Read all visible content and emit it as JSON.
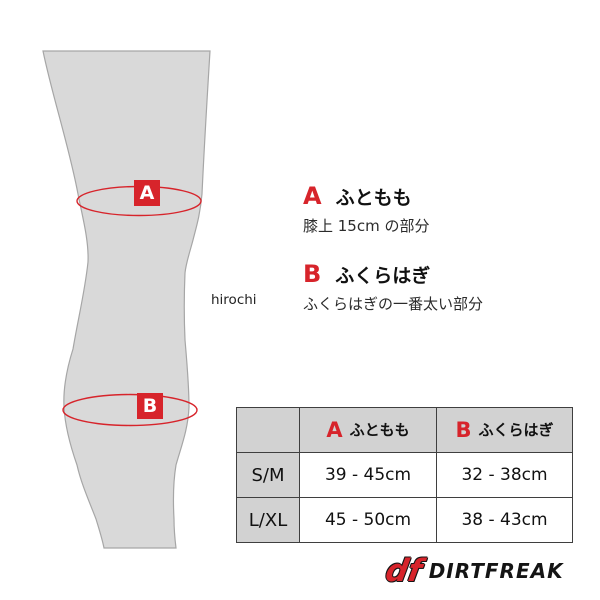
{
  "diagram": {
    "watermark": "hirochi",
    "markers": [
      {
        "letter": "A"
      },
      {
        "letter": "B"
      }
    ]
  },
  "legend": {
    "items": [
      {
        "letter": "A",
        "title": "ふともも",
        "desc": "膝上 15cm の部分"
      },
      {
        "letter": "B",
        "title": "ふくらはぎ",
        "desc": "ふくらはぎの一番太い部分"
      }
    ]
  },
  "size_table": {
    "header": {
      "columns": [
        {
          "letter": "A",
          "label": "ふともも"
        },
        {
          "letter": "B",
          "label": "ふくらはぎ"
        }
      ]
    },
    "rows": [
      {
        "size": "S/M",
        "thigh": "39 - 45cm",
        "calf": "32 - 38cm"
      },
      {
        "size": "L/XL",
        "thigh": "45 - 50cm",
        "calf": "38 - 43cm"
      }
    ]
  },
  "brand": {
    "emblem": "df",
    "name": "DIRTFREAK"
  },
  "colors": {
    "accent_red": "#d7242b",
    "leg_fill": "#d9d9d9",
    "leg_outline": "#a6a6a6",
    "table_gray": "#d2d2d2",
    "table_border": "#3f3f3f"
  }
}
